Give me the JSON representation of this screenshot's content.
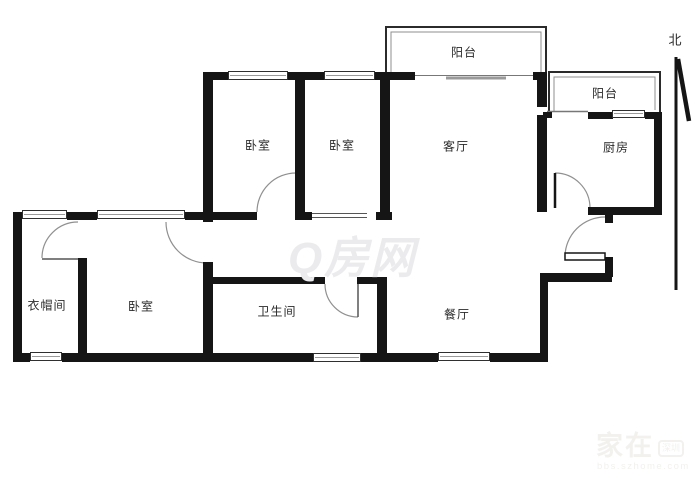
{
  "plan": {
    "north_label": "北",
    "rooms": {
      "balcony_top": "阳台",
      "balcony_right": "阳台",
      "bedroom_a": "卧室",
      "bedroom_b": "卧室",
      "living": "客厅",
      "kitchen": "厨房",
      "cloakroom": "衣帽间",
      "bedroom_c": "卧室",
      "bathroom": "卫生间",
      "dining": "餐厅"
    },
    "watermarks": {
      "center": "Q房网",
      "corner_main": "家在",
      "corner_badge": "深圳",
      "corner_sub": "bbs.szhome.com"
    },
    "colors": {
      "wall": "#151515",
      "thin_line": "#8f8f8f",
      "label": "#2a2a2a",
      "watermark_center": "#ebebee",
      "watermark_corner": "#f2f1ee"
    }
  }
}
